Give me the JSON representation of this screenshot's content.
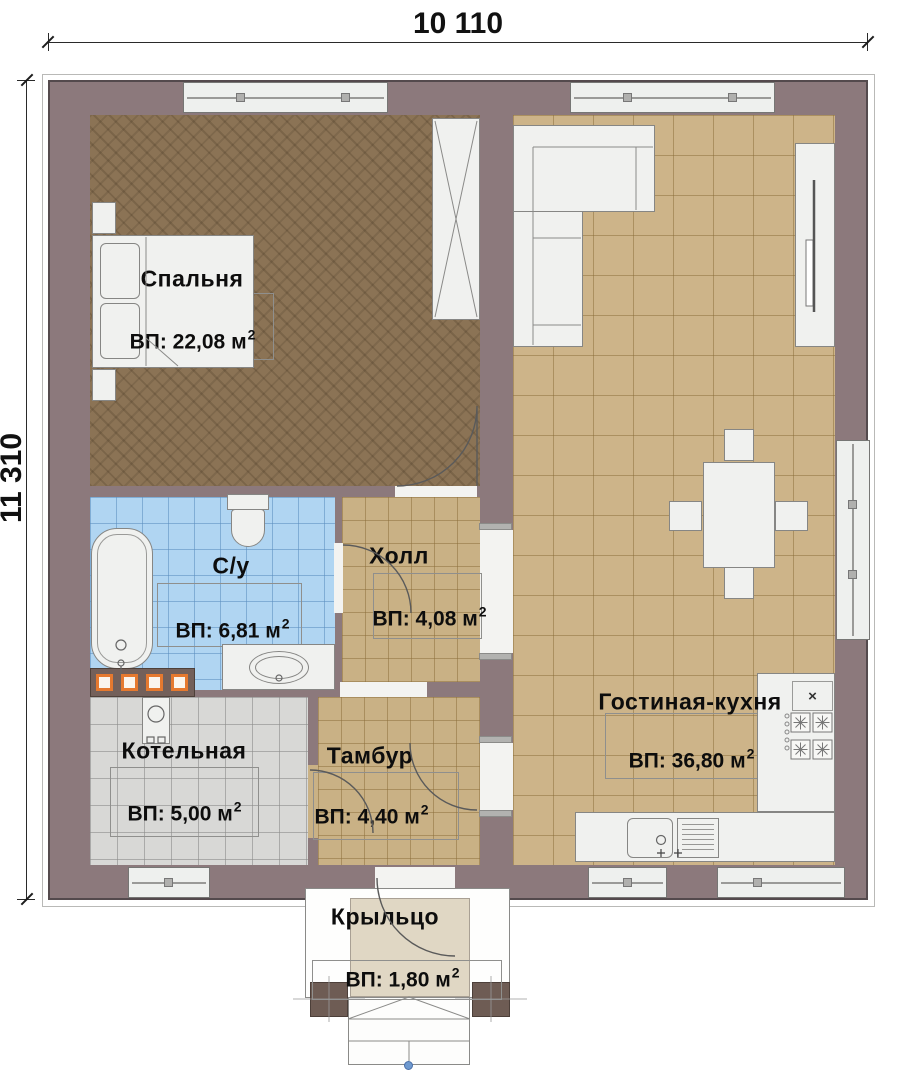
{
  "dimensions": {
    "top": "10 110",
    "left": "11 310"
  },
  "rooms": {
    "bedroom": {
      "name": "Спальня",
      "area": "ВП: 22,08 м",
      "area_sup": "2"
    },
    "bathroom": {
      "name": "С/у",
      "area": "ВП: 6,81 м",
      "area_sup": "2"
    },
    "hall": {
      "name": "Холл",
      "area": "ВП: 4,08 м",
      "area_sup": "2"
    },
    "boiler": {
      "name": "Котельная",
      "area": "ВП: 5,00 м",
      "area_sup": "2"
    },
    "vestibule": {
      "name": "Тамбур",
      "area": "ВП: 4,40 м",
      "area_sup": "2"
    },
    "living": {
      "name": "Гостиная-кухня",
      "area": "ВП: 36,80 м",
      "area_sup": "2"
    },
    "porch": {
      "name": "Крыльцо",
      "area": "ВП: 1,80 м",
      "area_sup": "2"
    }
  },
  "kitchen": {
    "vent_mark": "×"
  },
  "colors": {
    "wall": "#8c797c",
    "bedroom_floor": "#8b7355",
    "tile_tan": "#cdb489",
    "tile_blue": "#b0d5f2",
    "tile_gray": "#d8d8d6",
    "porch_floor": "#e0d7c4",
    "heater_orange": "#e5792f",
    "marker_blue": "#6f9ad0"
  }
}
